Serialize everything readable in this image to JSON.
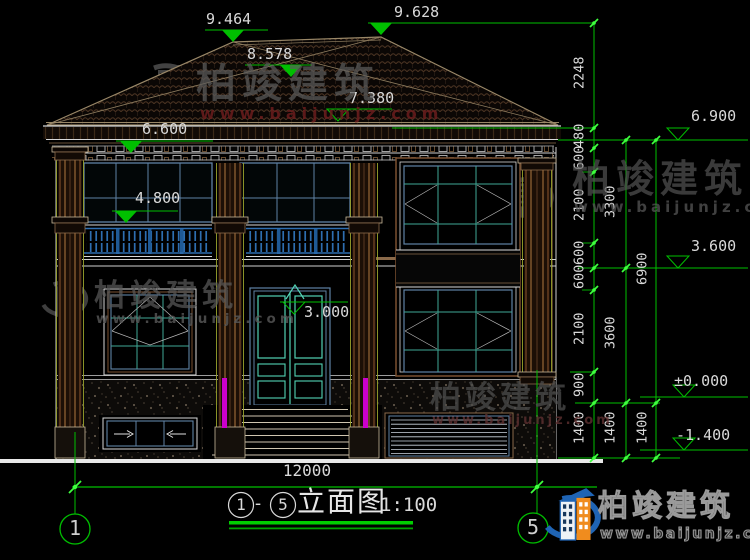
{
  "drawing": {
    "title": {
      "axis_start": "1",
      "separator": "-",
      "axis_end": "5",
      "name": "立面图",
      "scale": "1:100"
    },
    "axes": {
      "left": "1",
      "right": "5"
    },
    "levels": {
      "ridge_left": "9.464",
      "ridge_right": "9.628",
      "roof_mid": "8.578",
      "eave_top": "7.380",
      "eave_bottom": "6.900",
      "window_head": "6.600",
      "window_sill": "4.800",
      "door_head": "3.000",
      "second_floor": "3.600",
      "ground_floor": "±0.000",
      "site": "-1.400"
    },
    "dims": {
      "total_width": "12000",
      "chain_a": [
        "2248",
        "480",
        "600",
        "2100",
        "600",
        "600",
        "2100",
        "900",
        "1400"
      ],
      "chain_b": [
        "3300",
        "3600",
        "1400"
      ],
      "chain_c": [
        "6900",
        "1400"
      ]
    },
    "watermark": {
      "brand": "柏竣建筑",
      "url": "www.baijunjz.com"
    },
    "logo": {
      "brand": "柏竣建筑",
      "url": "www.baijunjz.com"
    },
    "colors": {
      "background": "#000000",
      "dimension_green": "#00bf00",
      "tick_green": "#3fff3f",
      "text": "#d9d9d9",
      "roof_line": "#9a8868",
      "tile": "#4a3322",
      "window_frame_blue": "#5f82a5",
      "mullion_teal": "#3fa896",
      "door_teal": "#52d2b4",
      "railing_blue": "#2e6eb0",
      "column_brown": "#7a4a28",
      "olive_edge": "#9aa22c",
      "downspout_magenta": "#cc00cc",
      "ground_white": "#e8e8e8",
      "watermark_gray": "#5c5c5c",
      "watermark_red": "#6b1d1d",
      "logo_blue": "#1f64b4",
      "logo_orange": "#f08c1e"
    }
  }
}
